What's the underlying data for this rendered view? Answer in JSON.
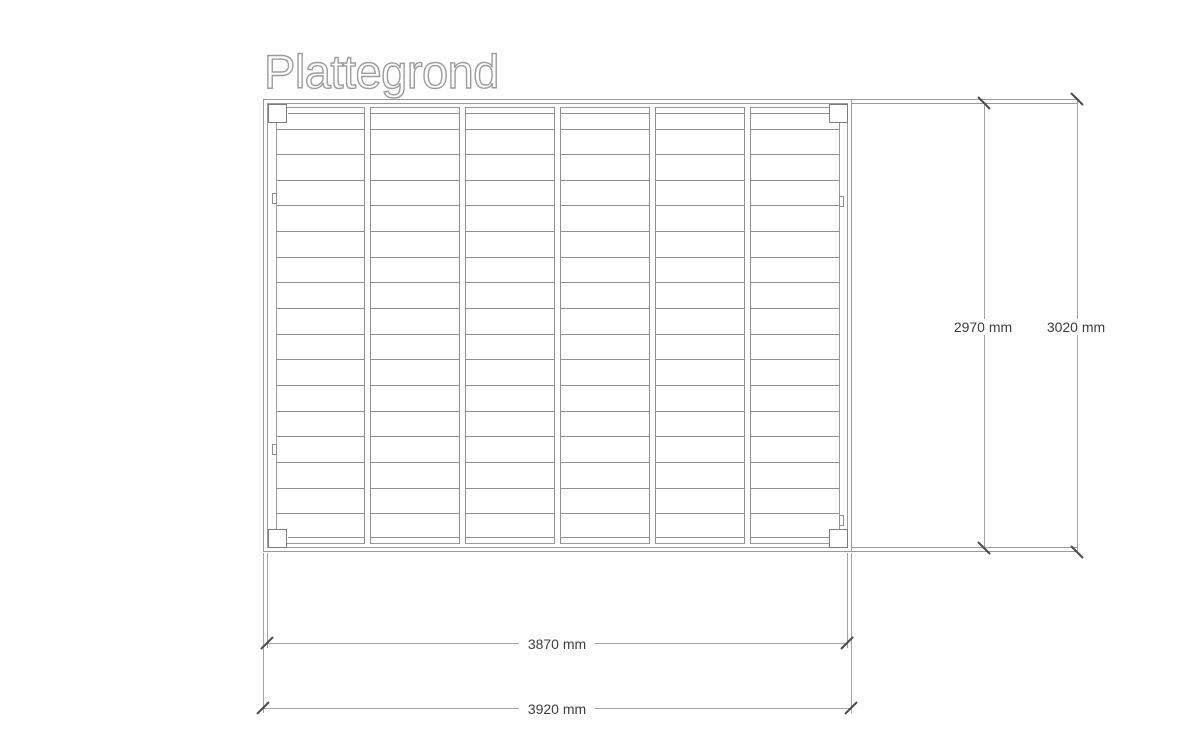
{
  "title": "Plattegrond",
  "drawing": {
    "type": "floor-plan-top-view",
    "bays": 6,
    "joists": 5,
    "plank_lines_per_bay": 16,
    "corner_posts": 4,
    "connector_marks": 4
  },
  "dimensions": {
    "right": [
      {
        "name": "inner-height",
        "label": "2970 mm"
      },
      {
        "name": "outer-height",
        "label": "3020 mm"
      }
    ],
    "bottom": [
      {
        "name": "inner-width",
        "label": "3870 mm"
      },
      {
        "name": "outer-width",
        "label": "3920 mm"
      }
    ]
  },
  "colors": {
    "frame_line": "#9a9a9a",
    "plank_line": "#8f8f8f",
    "dimension_line": "#a3a3a3",
    "tick": "#4b4b4b",
    "text": "#3d3d3d",
    "title_outline": "#9c9c9c",
    "background": "#ffffff"
  }
}
